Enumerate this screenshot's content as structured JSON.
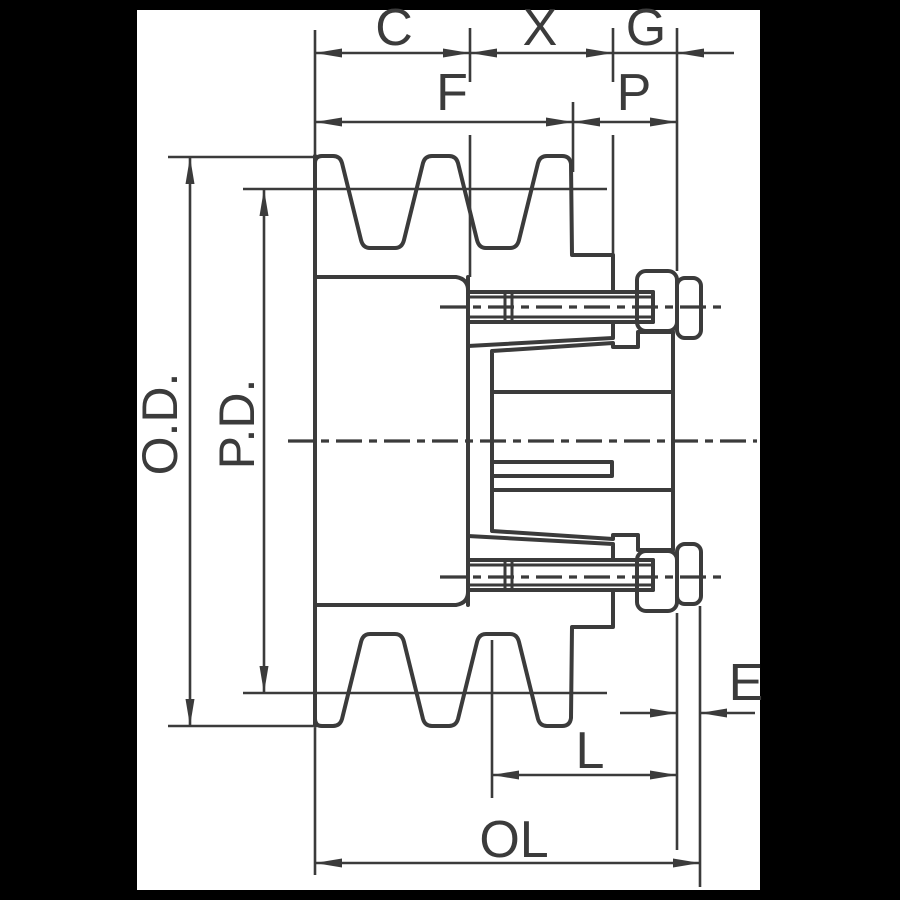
{
  "colors": {
    "background": "#000000",
    "paper": "#ffffff",
    "ink": "#3b3b3b"
  },
  "labels": {
    "c": "C",
    "x": "X",
    "g": "G",
    "f": "F",
    "p": "P",
    "od": "O.D.",
    "pd": "P.D.",
    "e": "E",
    "l": "L",
    "ol": "OL"
  }
}
